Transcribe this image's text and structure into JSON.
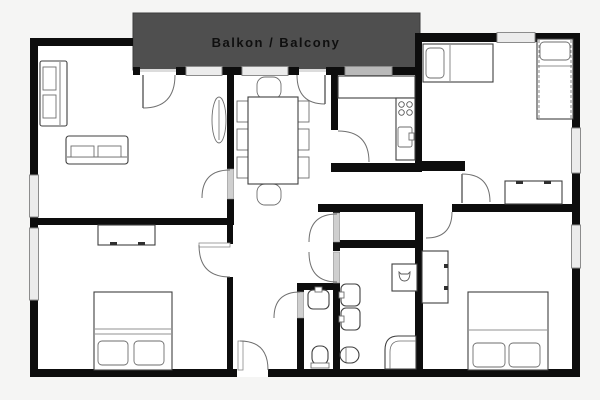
{
  "balcony": {
    "label": "Balkon / Balcony"
  },
  "colors": {
    "background": "#f5f5f4",
    "floor": "#ffffff",
    "wall": "#0d0d0d",
    "balcony_fill": "#4f4f4f",
    "balcony_text": "#0f0f0f",
    "window_fill": "#ececec",
    "window_dark_fill": "#b9b9b9"
  }
}
